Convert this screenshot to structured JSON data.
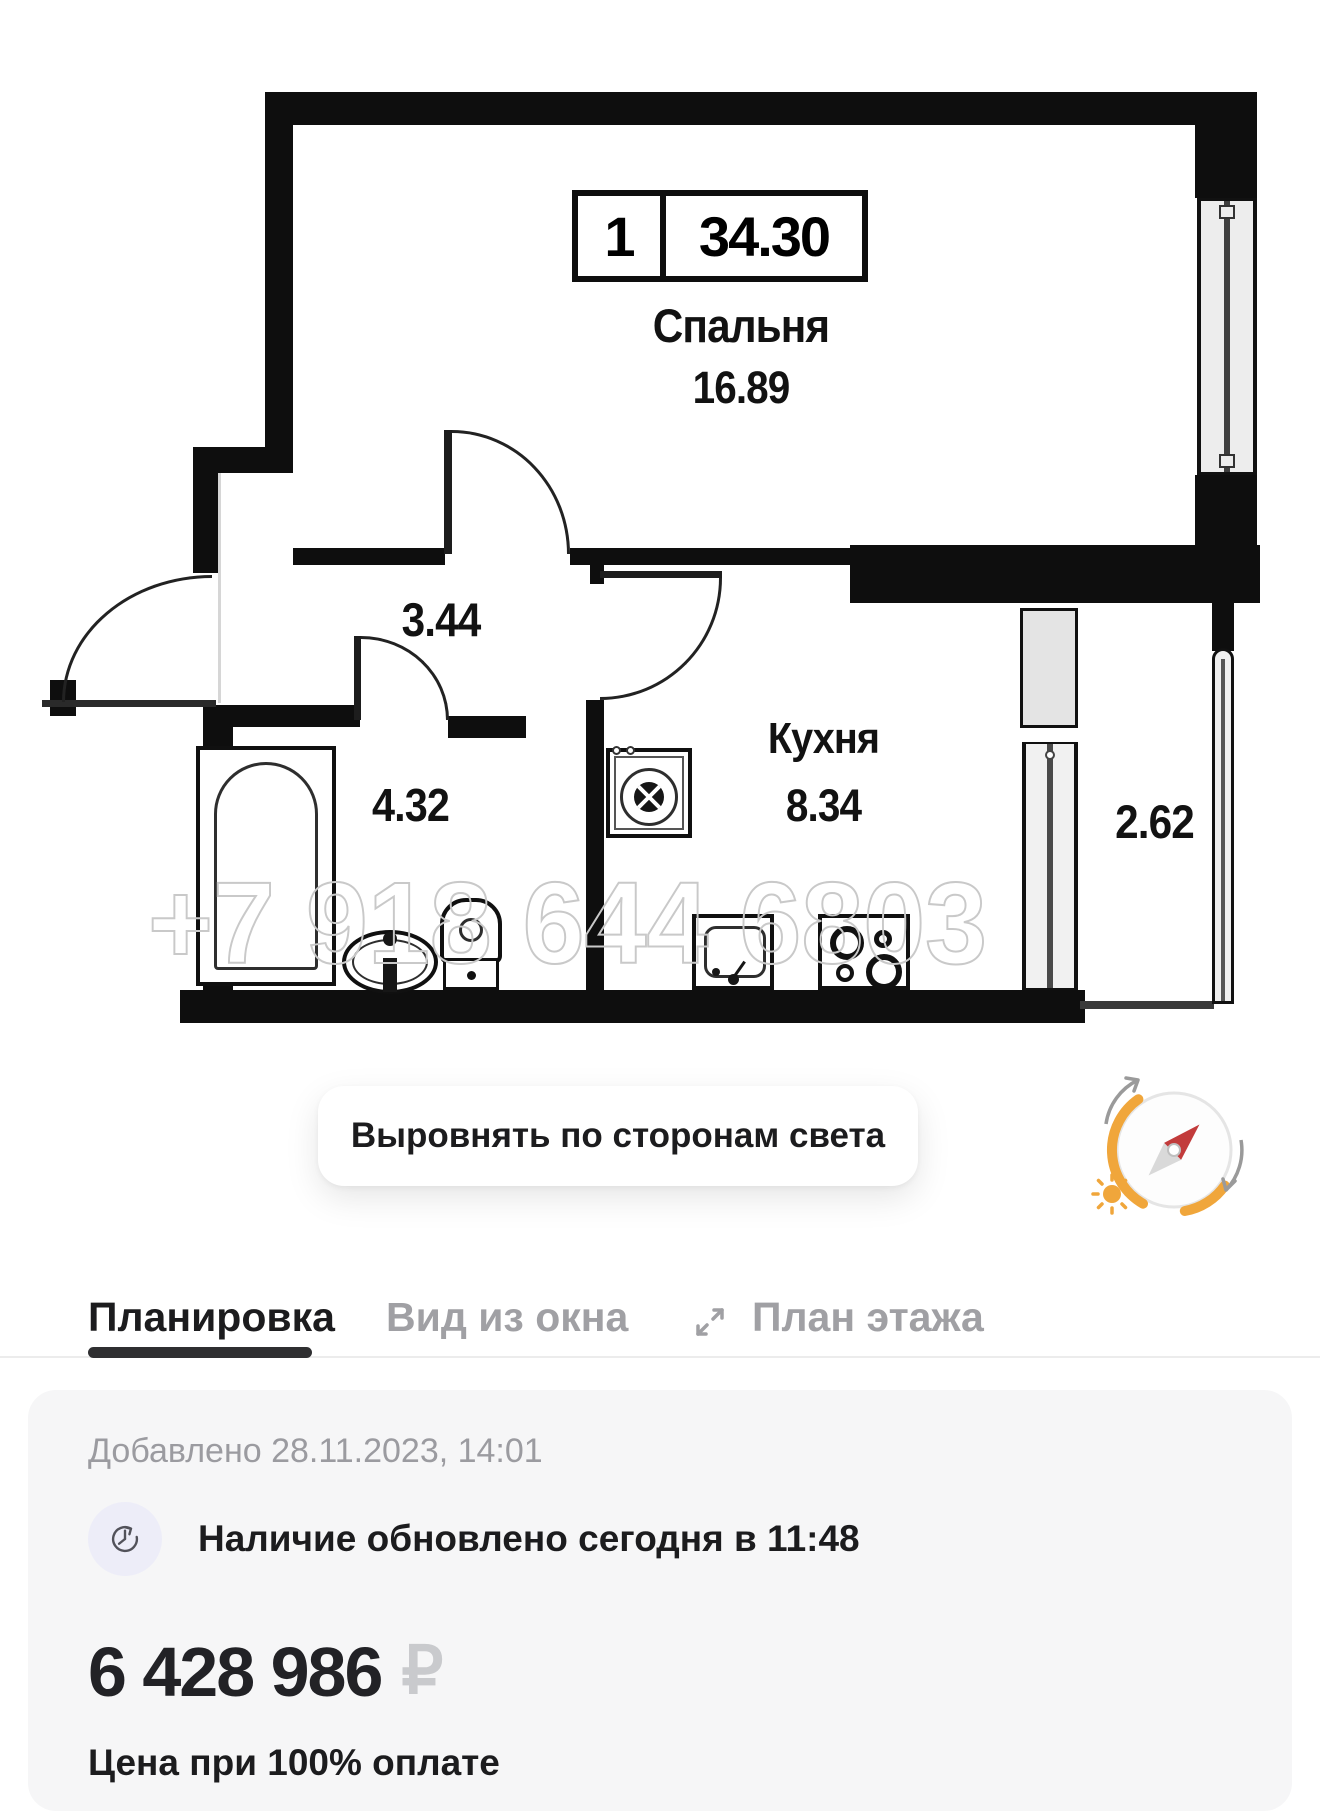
{
  "plan": {
    "unit_box": {
      "rooms_count": "1",
      "total_area": "34.30"
    },
    "bedroom": {
      "name": "Спальня",
      "area": "16.89"
    },
    "hallway": {
      "area": "3.44"
    },
    "kitchen": {
      "name": "Кухня",
      "area": "8.34"
    },
    "bathroom": {
      "area": "4.32"
    },
    "balcony": {
      "area": "2.62"
    },
    "watermark": "+7 918 644 6803"
  },
  "controls": {
    "align_button": "Выровнять по сторонам света"
  },
  "tabs": [
    {
      "label": "Планировка",
      "active": true
    },
    {
      "label": "Вид из окна",
      "active": false
    },
    {
      "label": "План этажа",
      "active": false
    }
  ],
  "info": {
    "added": "Добавлено 28.11.2023, 14:01",
    "availability": "Наличие обновлено сегодня в 11:48",
    "price": "6 428 986",
    "currency": "₽",
    "price_note": "Цена при 100% оплате"
  },
  "colors": {
    "accent_orange": "#F0A63B",
    "needle_red": "#C23B3B",
    "wall_black": "#0E0E0E",
    "text_dark": "#1C1C1E",
    "text_gray": "#9B9BA0",
    "card_bg": "#F6F6F7"
  }
}
